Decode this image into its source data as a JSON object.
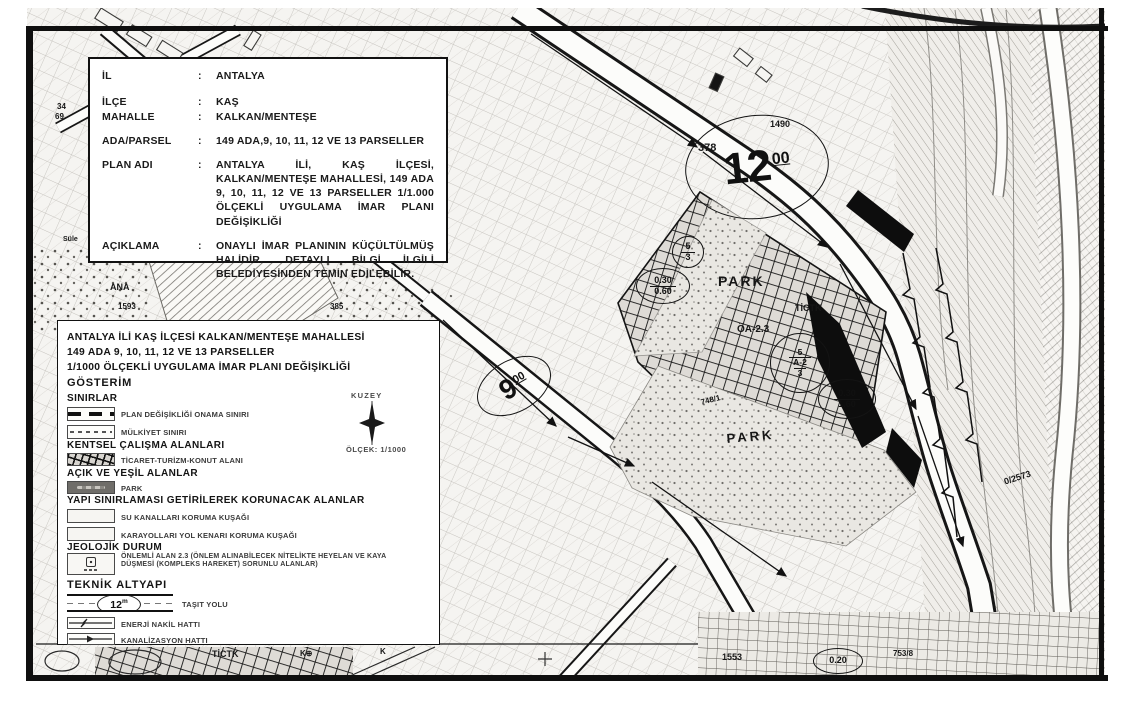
{
  "info_box": {
    "colon": ":",
    "rows": [
      {
        "label": "İL",
        "value": "ANTALYA"
      },
      {
        "label": "İLÇE",
        "value": "KAŞ"
      },
      {
        "label": "MAHALLE",
        "value": "KALKAN/MENTEŞE"
      },
      {
        "label": "ADA/PARSEL",
        "value": "149 ADA,9, 10, 11, 12 VE 13 PARSELLER"
      },
      {
        "label": "PLAN ADI",
        "value": "ANTALYA İLİ, KAŞ İLÇESİ, KALKAN/MENTEŞE MAHALLESİ, 149 ADA 9, 10, 11, 12 VE 13 PARSELLER 1/1.000 ÖLÇEKLİ UYGULAMA İMAR PLANI DEĞİŞİKLİĞİ"
      },
      {
        "label": "AÇIKLAMA",
        "value": "ONAYLI İMAR PLANININ KÜÇÜLTÜLMÜŞ HALİDİR. DETAYLI BİLGİ İLGİLİ BELEDİYESİNDEN TEMİN EDİLEBİLİR."
      }
    ]
  },
  "legend": {
    "title_lines": [
      "ANTALYA İLİ KAŞ İLÇESİ KALKAN/MENTEŞE MAHALLESİ",
      "149 ADA 9, 10, 11, 12 VE 13 PARSELLER",
      "1/1000 ÖLÇEKLİ UYGULAMA İMAR PLANI DEĞİŞİKLİĞİ"
    ],
    "gosterim_label": "GÖSTERİM",
    "north_label": "KUZEY",
    "scale_label": "ÖLÇEK: 1/1000",
    "sections": [
      {
        "heading": "SINIRLAR",
        "items": [
          {
            "label": "PLAN DEĞİŞİKLİĞİ ONAMA SINIRI"
          },
          {
            "label": "MÜLKİYET SINIRI"
          }
        ]
      },
      {
        "heading": "KENTSEL ÇALIŞMA ALANLARI",
        "items": [
          {
            "label": "TİCARET-TURİZM-KONUT ALANI"
          }
        ]
      },
      {
        "heading": "AÇIK VE YEŞİL ALANLAR",
        "items": [
          {
            "label": "PARK"
          }
        ]
      },
      {
        "heading": "YAPI SINIRLAMASI GETİRİLEREK KORUNACAK ALANLAR",
        "items": [
          {
            "label": "SU KANALLARI KORUMA KUŞAĞI"
          },
          {
            "label": "KARAYOLLARI YOL KENARI KORUMA KUŞAĞI"
          }
        ]
      },
      {
        "heading": "JEOLOJİK DURUM",
        "items": [
          {
            "label": "ÖNLEMLİ ALAN 2.3 (ÖNLEM ALINABİLECEK NİTELİKTE HEYELAN VE KAYA DÜŞMESİ (KOMPLEKS HAREKET) SORUNLU ALANLAR)"
          }
        ]
      },
      {
        "heading": "TEKNİK ALTYAPI",
        "items": [
          {
            "label": "TAŞIT YOLU",
            "road_width": "12",
            "road_width_unit": "m"
          },
          {
            "label": "ENERJİ NAKİL HATTI"
          },
          {
            "label": "KANALİZASYON HATTI"
          }
        ]
      }
    ]
  },
  "map": {
    "labels": [
      {
        "t": "378",
        "x": 698,
        "y": 143,
        "fs": 11,
        "b": 1
      },
      {
        "t": "1490",
        "x": 770,
        "y": 120,
        "fs": 9
      },
      {
        "t": "PARK",
        "x": 718,
        "y": 274,
        "fs": 14,
        "b": 1,
        "ls": 2
      },
      {
        "t": "PARK",
        "x": 726,
        "y": 432,
        "fs": 13,
        "b": 1,
        "ls": 3,
        "rot": -5
      },
      {
        "t": "TİCTK",
        "x": 795,
        "y": 304,
        "fs": 9,
        "b": 1
      },
      {
        "t": "TİCTK",
        "x": 212,
        "y": 650,
        "fs": 9,
        "b": 1
      },
      {
        "t": "ÖA-2.3",
        "x": 737,
        "y": 325,
        "fs": 10,
        "b": 1
      },
      {
        "t": "748/1",
        "x": 700,
        "y": 399,
        "fs": 8,
        "rot": -14
      },
      {
        "t": "ANA",
        "x": 110,
        "y": 283,
        "fs": 9,
        "b": 1
      },
      {
        "t": "1593",
        "x": 118,
        "y": 303,
        "fs": 8
      },
      {
        "t": "385",
        "x": 330,
        "y": 303,
        "fs": 8
      },
      {
        "t": "34",
        "x": 57,
        "y": 103,
        "fs": 8
      },
      {
        "t": "69.",
        "x": 55,
        "y": 113,
        "fs": 8
      },
      {
        "t": "Süle",
        "x": 63,
        "y": 236,
        "fs": 7
      },
      {
        "t": "0/2573",
        "x": 1003,
        "y": 478,
        "fs": 9,
        "rot": -18
      },
      {
        "t": "1553",
        "x": 722,
        "y": 653,
        "fs": 9
      },
      {
        "t": "753/8",
        "x": 893,
        "y": 650,
        "fs": 8
      },
      {
        "t": "K⊕",
        "x": 300,
        "y": 650,
        "fs": 8,
        "b": 1
      },
      {
        "t": "K",
        "x": 380,
        "y": 648,
        "fs": 8,
        "b": 1
      }
    ],
    "ellipse_labels": [
      {
        "big": true,
        "main": "12",
        "sup": "00",
        "cx": 757,
        "cy": 167,
        "rx": 72,
        "ry": 52,
        "fs": 44,
        "sfs": 16,
        "rot": -6
      },
      {
        "big": true,
        "main": "9",
        "sup": "00",
        "cx": 514,
        "cy": 386,
        "rx": 40,
        "ry": 26,
        "fs": 28,
        "sfs": 11,
        "rot": -30
      },
      {
        "lines": [
          "0.30",
          "0.60"
        ],
        "cx": 663,
        "cy": 286,
        "rx": 27,
        "ry": 18,
        "fs": 9
      },
      {
        "lines": [
          "0.30",
          "1.60"
        ],
        "cx": 847,
        "cy": 399,
        "rx": 29,
        "ry": 20,
        "fs": 9
      },
      {
        "lines": [
          "0.20"
        ],
        "cx": 838,
        "cy": 661,
        "rx": 25,
        "ry": 13,
        "fs": 9
      },
      {
        "lines": [
          "5",
          "3"
        ],
        "cx": 688,
        "cy": 252,
        "rx": 16,
        "ry": 16,
        "fs": 9
      },
      {
        "lines": [
          "5",
          "A-2",
          "3"
        ],
        "cx": 800,
        "cy": 363,
        "rx": 30,
        "ry": 30,
        "fs": 8.5
      }
    ]
  }
}
